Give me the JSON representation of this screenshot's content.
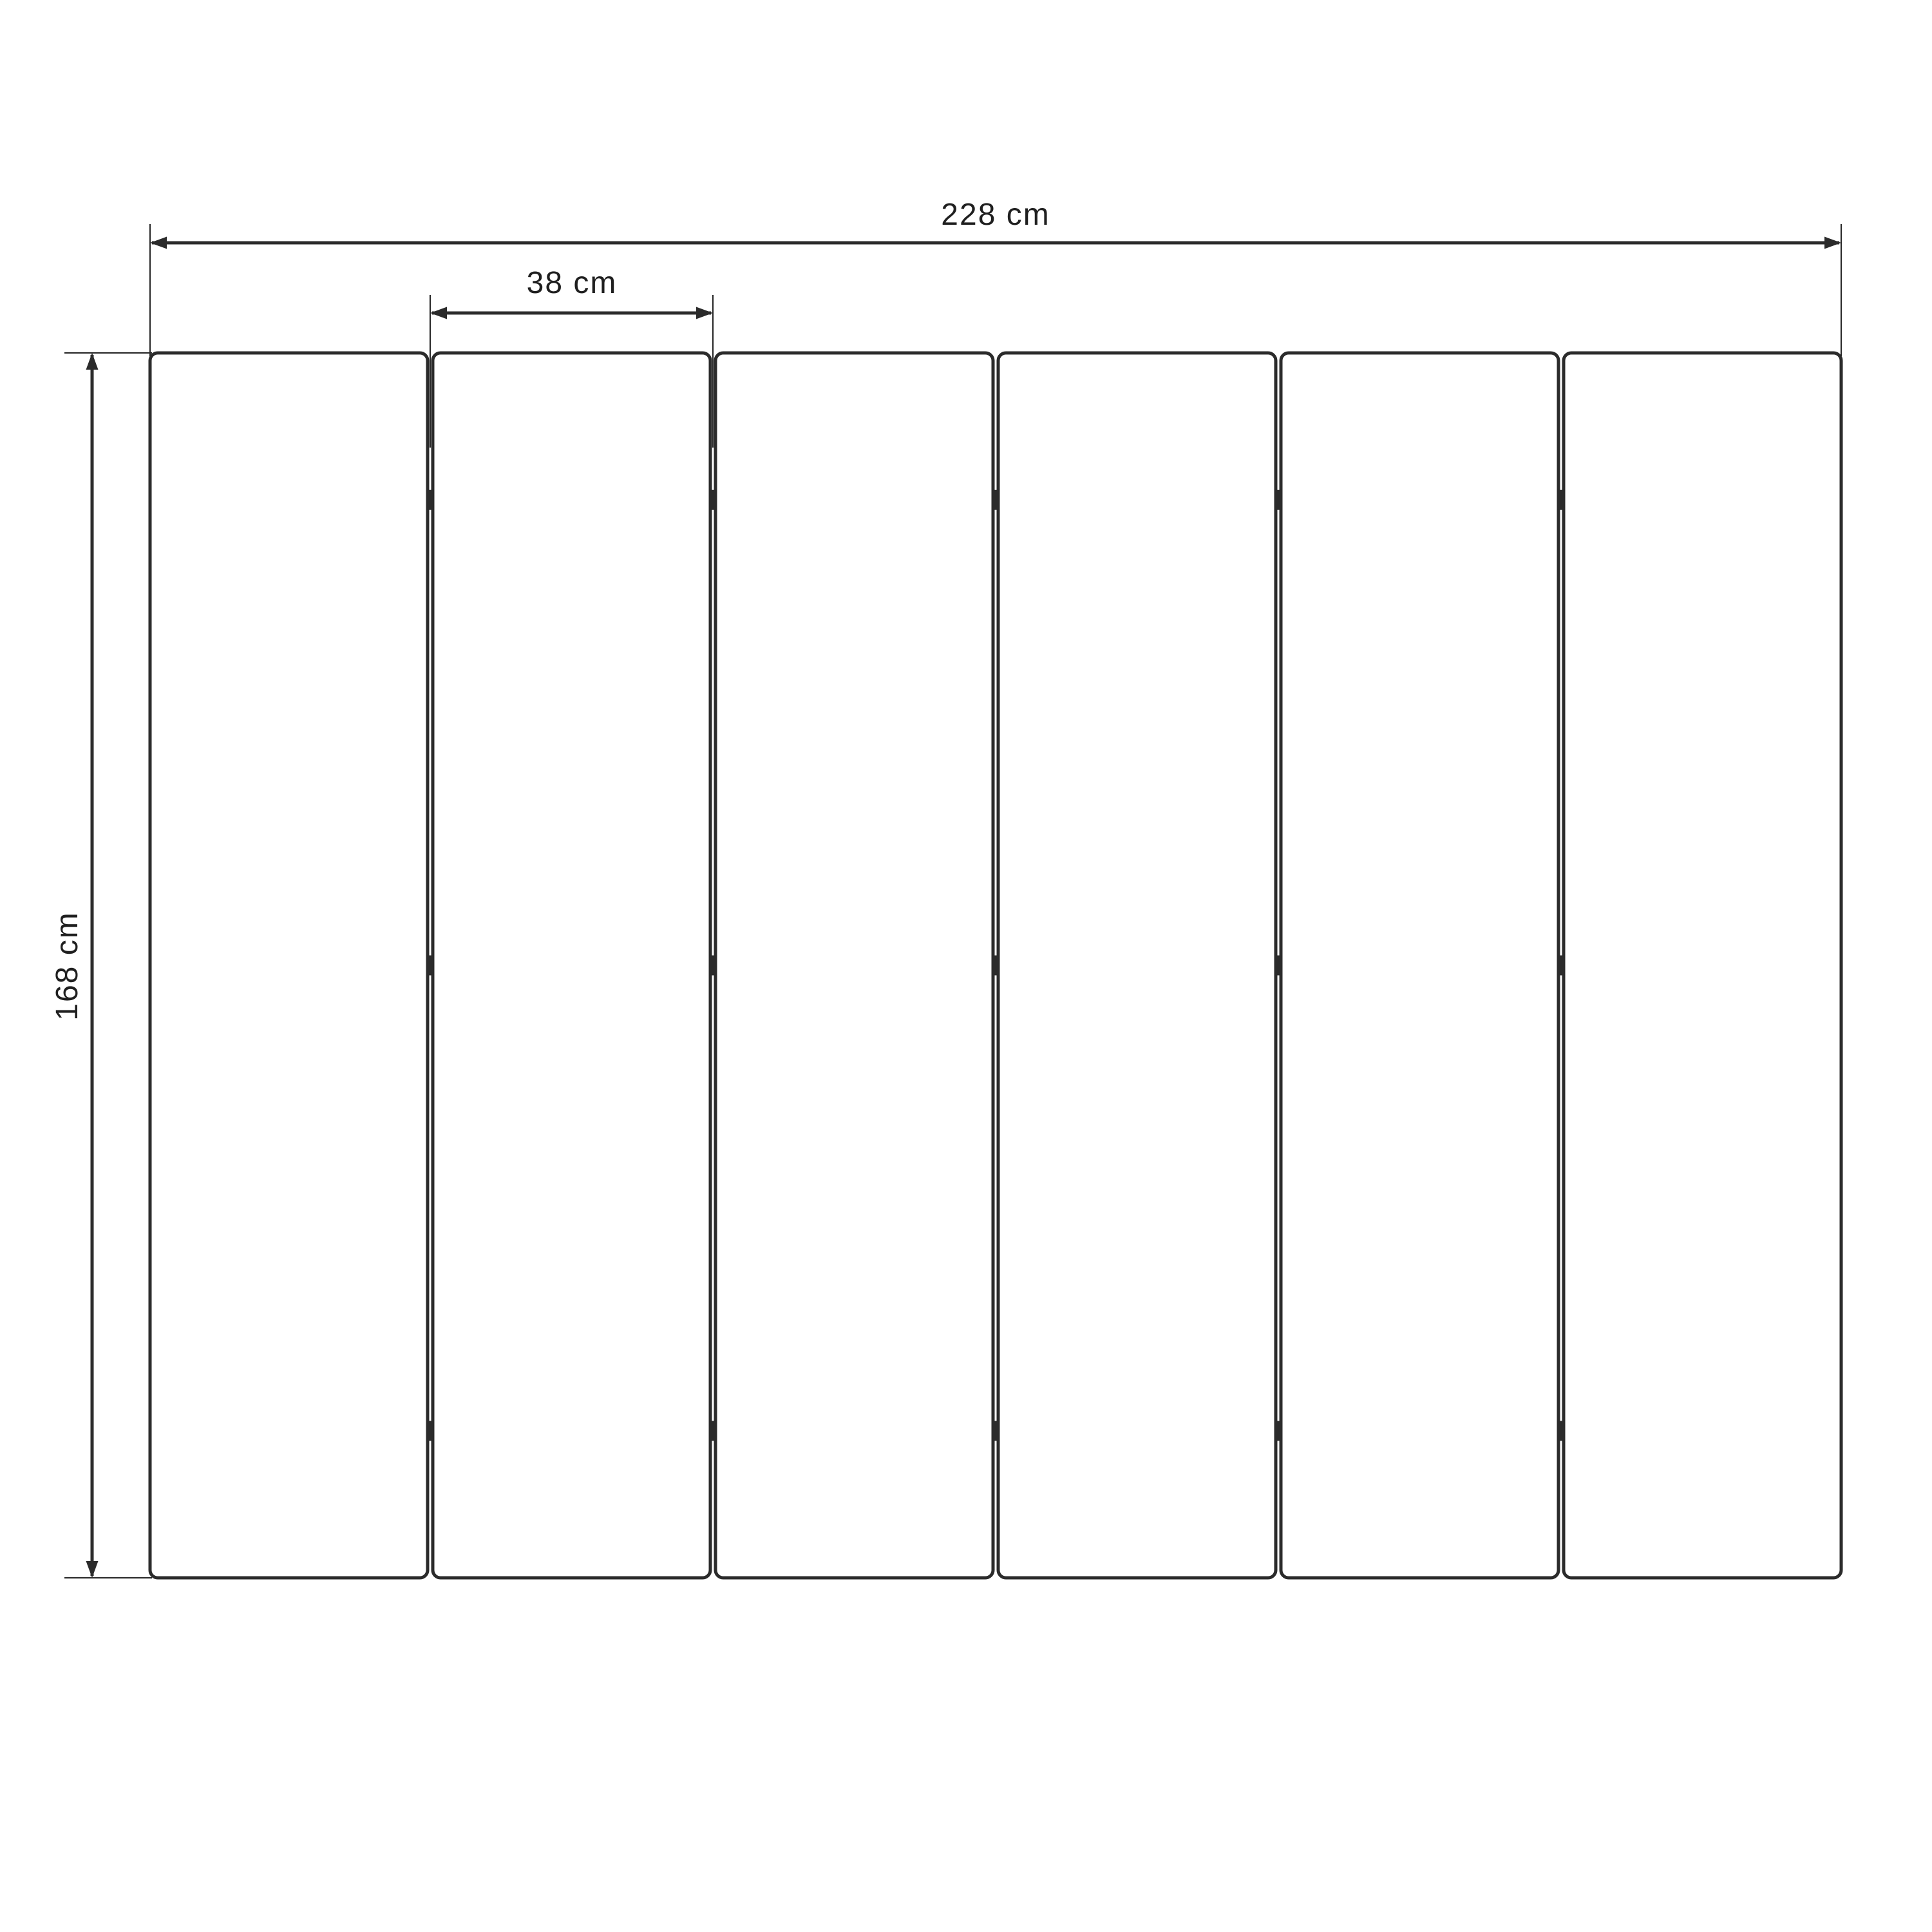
{
  "diagram": {
    "kind": "dimensioned-technical-drawing",
    "subject": "six-panel folding screen, front elevation",
    "panel_count": 6,
    "joint_count": 5,
    "hinges_per_joint": 3,
    "hinge_fractions": [
      0.12,
      0.5,
      0.88
    ],
    "dimensions": {
      "total_width": {
        "value": 228,
        "unit": "cm",
        "label": "228 cm"
      },
      "single_panel_width": {
        "value": 38,
        "unit": "cm",
        "label": "38 cm"
      },
      "height": {
        "value": 168,
        "unit": "cm",
        "label": "168 cm"
      }
    },
    "colors": {
      "ink": "#2b2b2b",
      "text": "#1f1f1f",
      "background": "#ffffff"
    }
  }
}
